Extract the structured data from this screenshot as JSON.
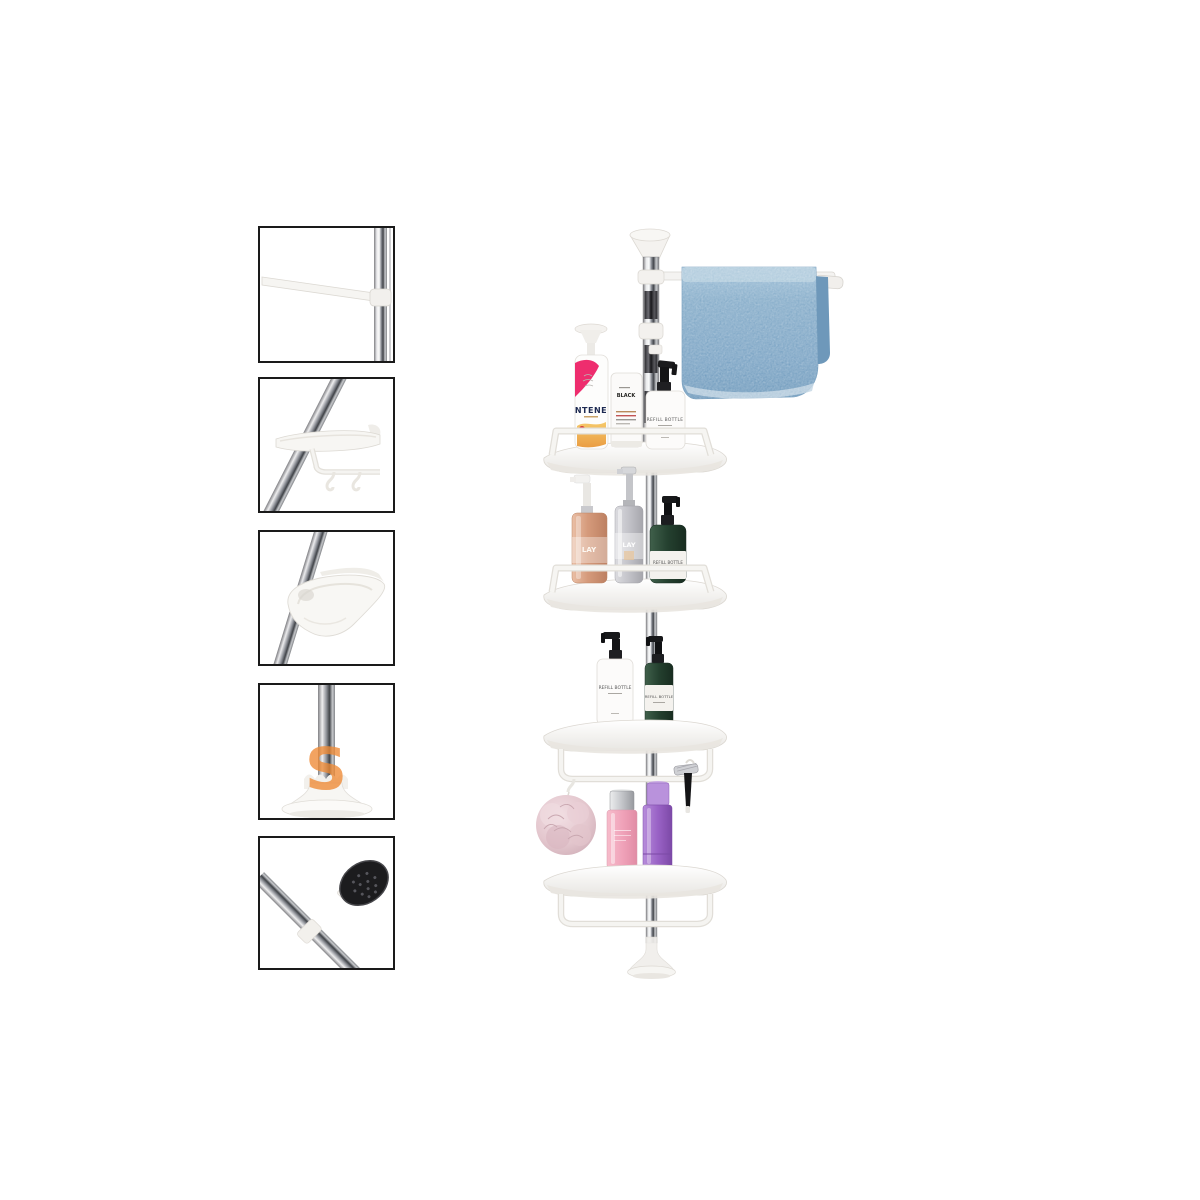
{
  "page": {
    "background_color": "#ffffff"
  },
  "watermark": {
    "letter": "S",
    "color": "#ef8a35"
  },
  "thumbnails": [
    {
      "name": "towel-bar-detail"
    },
    {
      "name": "shelf-hooks-detail"
    },
    {
      "name": "corner-shelf-detail"
    },
    {
      "name": "suction-base-detail"
    },
    {
      "name": "pole-end-pad-detail"
    }
  ],
  "product": {
    "bottle_labels": {
      "shampoo": "NTENE",
      "tube": "BLACK",
      "refill": "REFILL BOTTLE",
      "lotion": "LAY"
    },
    "colors": {
      "towel_blue": "#7ba6c9",
      "loofah_pink": "#e3c6cd",
      "bottle_pink": "#f0a3ba",
      "bottle_purple": "#9a63c6",
      "bottle_green": "#2c4936",
      "bottle_rose_gold": "#d59a7b",
      "bottle_silver": "#bfbfc5",
      "chrome_pole": "#9a9da3",
      "white_plastic": "#f5f4f1"
    }
  }
}
